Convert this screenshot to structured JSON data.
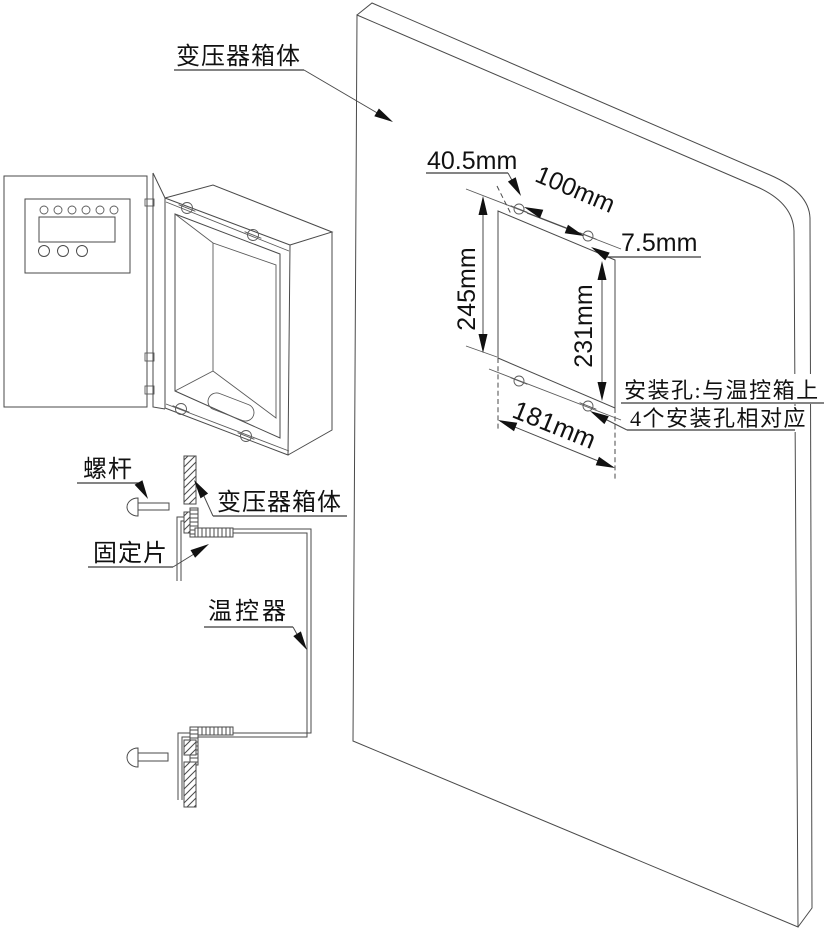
{
  "colors": {
    "background": "#ffffff",
    "line": "#4a4a4a",
    "text": "#111111",
    "arrow": "#111111"
  },
  "labels": {
    "panel_top": "变压器箱体",
    "screw": "螺杆",
    "wall_section": "变压器箱体",
    "fixing_piece": "固定片",
    "thermostat": "温控器"
  },
  "dimensions": {
    "hole_offset_left": "40.5mm",
    "hole_spacing_horizontal": "100mm",
    "hole_edge_offset": "7.5mm",
    "hole_spacing_vertical": "245mm",
    "cutout_height": "231mm",
    "cutout_width": "181mm"
  },
  "note": {
    "line1": "安装孔:与温控箱上",
    "line2": "4个安装孔相对应"
  }
}
